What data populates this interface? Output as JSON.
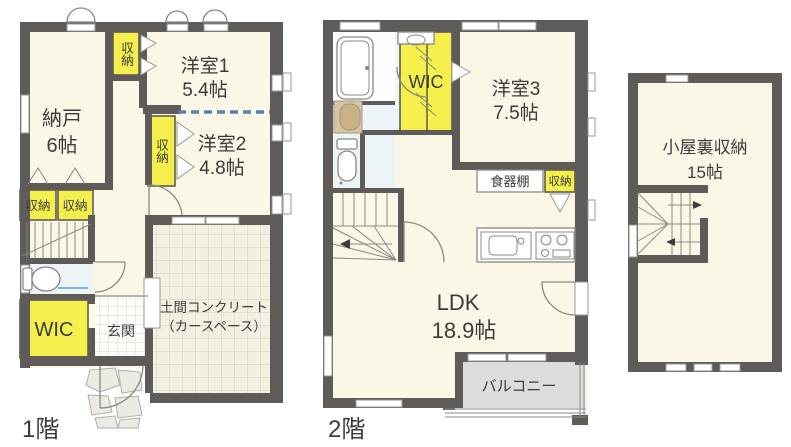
{
  "colors": {
    "wall": "#5f5b58",
    "floor": "#fbf7e6",
    "storage": "#f4ef4d",
    "balcony": "#dcdcda",
    "grid_line": "#cdccc3",
    "carspace_bg": "#f3f0e1",
    "tile_line": "#d8d8d2",
    "sanitary": "#edf4f6",
    "dashed_blue": "#5580b5",
    "washer": "#d9c49e",
    "text": "#3b3b3b"
  },
  "floor1": {
    "floor_label": "1階",
    "nando": {
      "line1": "納戸",
      "line2": "6帖"
    },
    "yoshitsu1": {
      "line1": "洋室1",
      "line2": "5.4帖"
    },
    "yoshitsu2": {
      "line1": "洋室2",
      "line2": "4.8帖"
    },
    "closet_top": "収納",
    "closet_mid": "収納",
    "closet_left1": "収納",
    "closet_left2": "収納",
    "wic": "WIC",
    "genkan": "玄関",
    "doma": {
      "line1": "土間コンクリート",
      "line2": "（カースペース）"
    }
  },
  "floor2": {
    "floor_label": "2階",
    "wic": "WIC",
    "yoshitsu3": {
      "line1": "洋室3",
      "line2": "7.5帖"
    },
    "ldk": {
      "line1": "LDK",
      "line2": "18.9帖"
    },
    "cupboard": "食器棚",
    "closet": "収納",
    "balcony": "バルコニー"
  },
  "attic": {
    "room": {
      "line1": "小屋裏収納",
      "line2": "15帖"
    }
  }
}
